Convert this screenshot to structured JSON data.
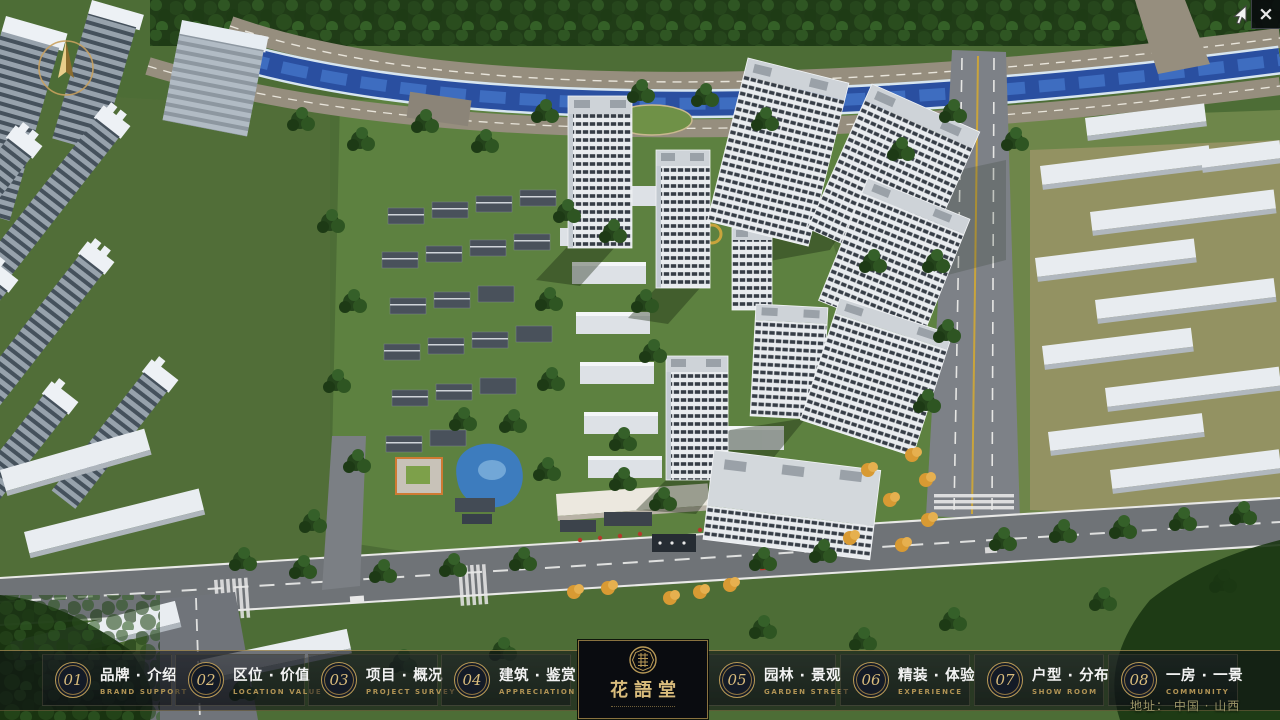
{
  "window": {
    "close_icon": "×"
  },
  "nav": {
    "items": [
      {
        "num": "01",
        "zh": "品牌 · 介绍",
        "en": "BRAND SUPPORT"
      },
      {
        "num": "02",
        "zh": "区位 · 价值",
        "en": "LOCATION VALUE"
      },
      {
        "num": "03",
        "zh": "项目 · 概况",
        "en": "PROJECT SURVEY"
      },
      {
        "num": "04",
        "zh": "建筑 · 鉴赏",
        "en": "APPRECIATION"
      },
      {
        "num": "05",
        "zh": "园林 · 景观",
        "en": "GARDEN STREET"
      },
      {
        "num": "06",
        "zh": "精装 · 体验",
        "en": "EXPERIENCE"
      },
      {
        "num": "07",
        "zh": "户型 · 分布",
        "en": "SHOW ROOM"
      },
      {
        "num": "08",
        "zh": "一房 · 一景",
        "en": "COMMUNITY"
      }
    ]
  },
  "logo": {
    "title": "花語堂"
  },
  "footer": {
    "address": "地址： 中国 · 山西"
  },
  "scene": {
    "description": "aerial-3d-masterplan-render",
    "palette": {
      "gold_accent": "#c9a96a",
      "bar_background": "rgba(12,15,20,0.55)",
      "river_blue": "#2a4fa0",
      "pond_blue": "#3d7cbe",
      "lawn_green": "#5d8140",
      "tree_green": "#26461c",
      "road_gray": "#6f7377",
      "tower_facade": "#e9ecef",
      "tower_window": "#363d46",
      "autumn_tree_orange": "#d89a33"
    }
  }
}
